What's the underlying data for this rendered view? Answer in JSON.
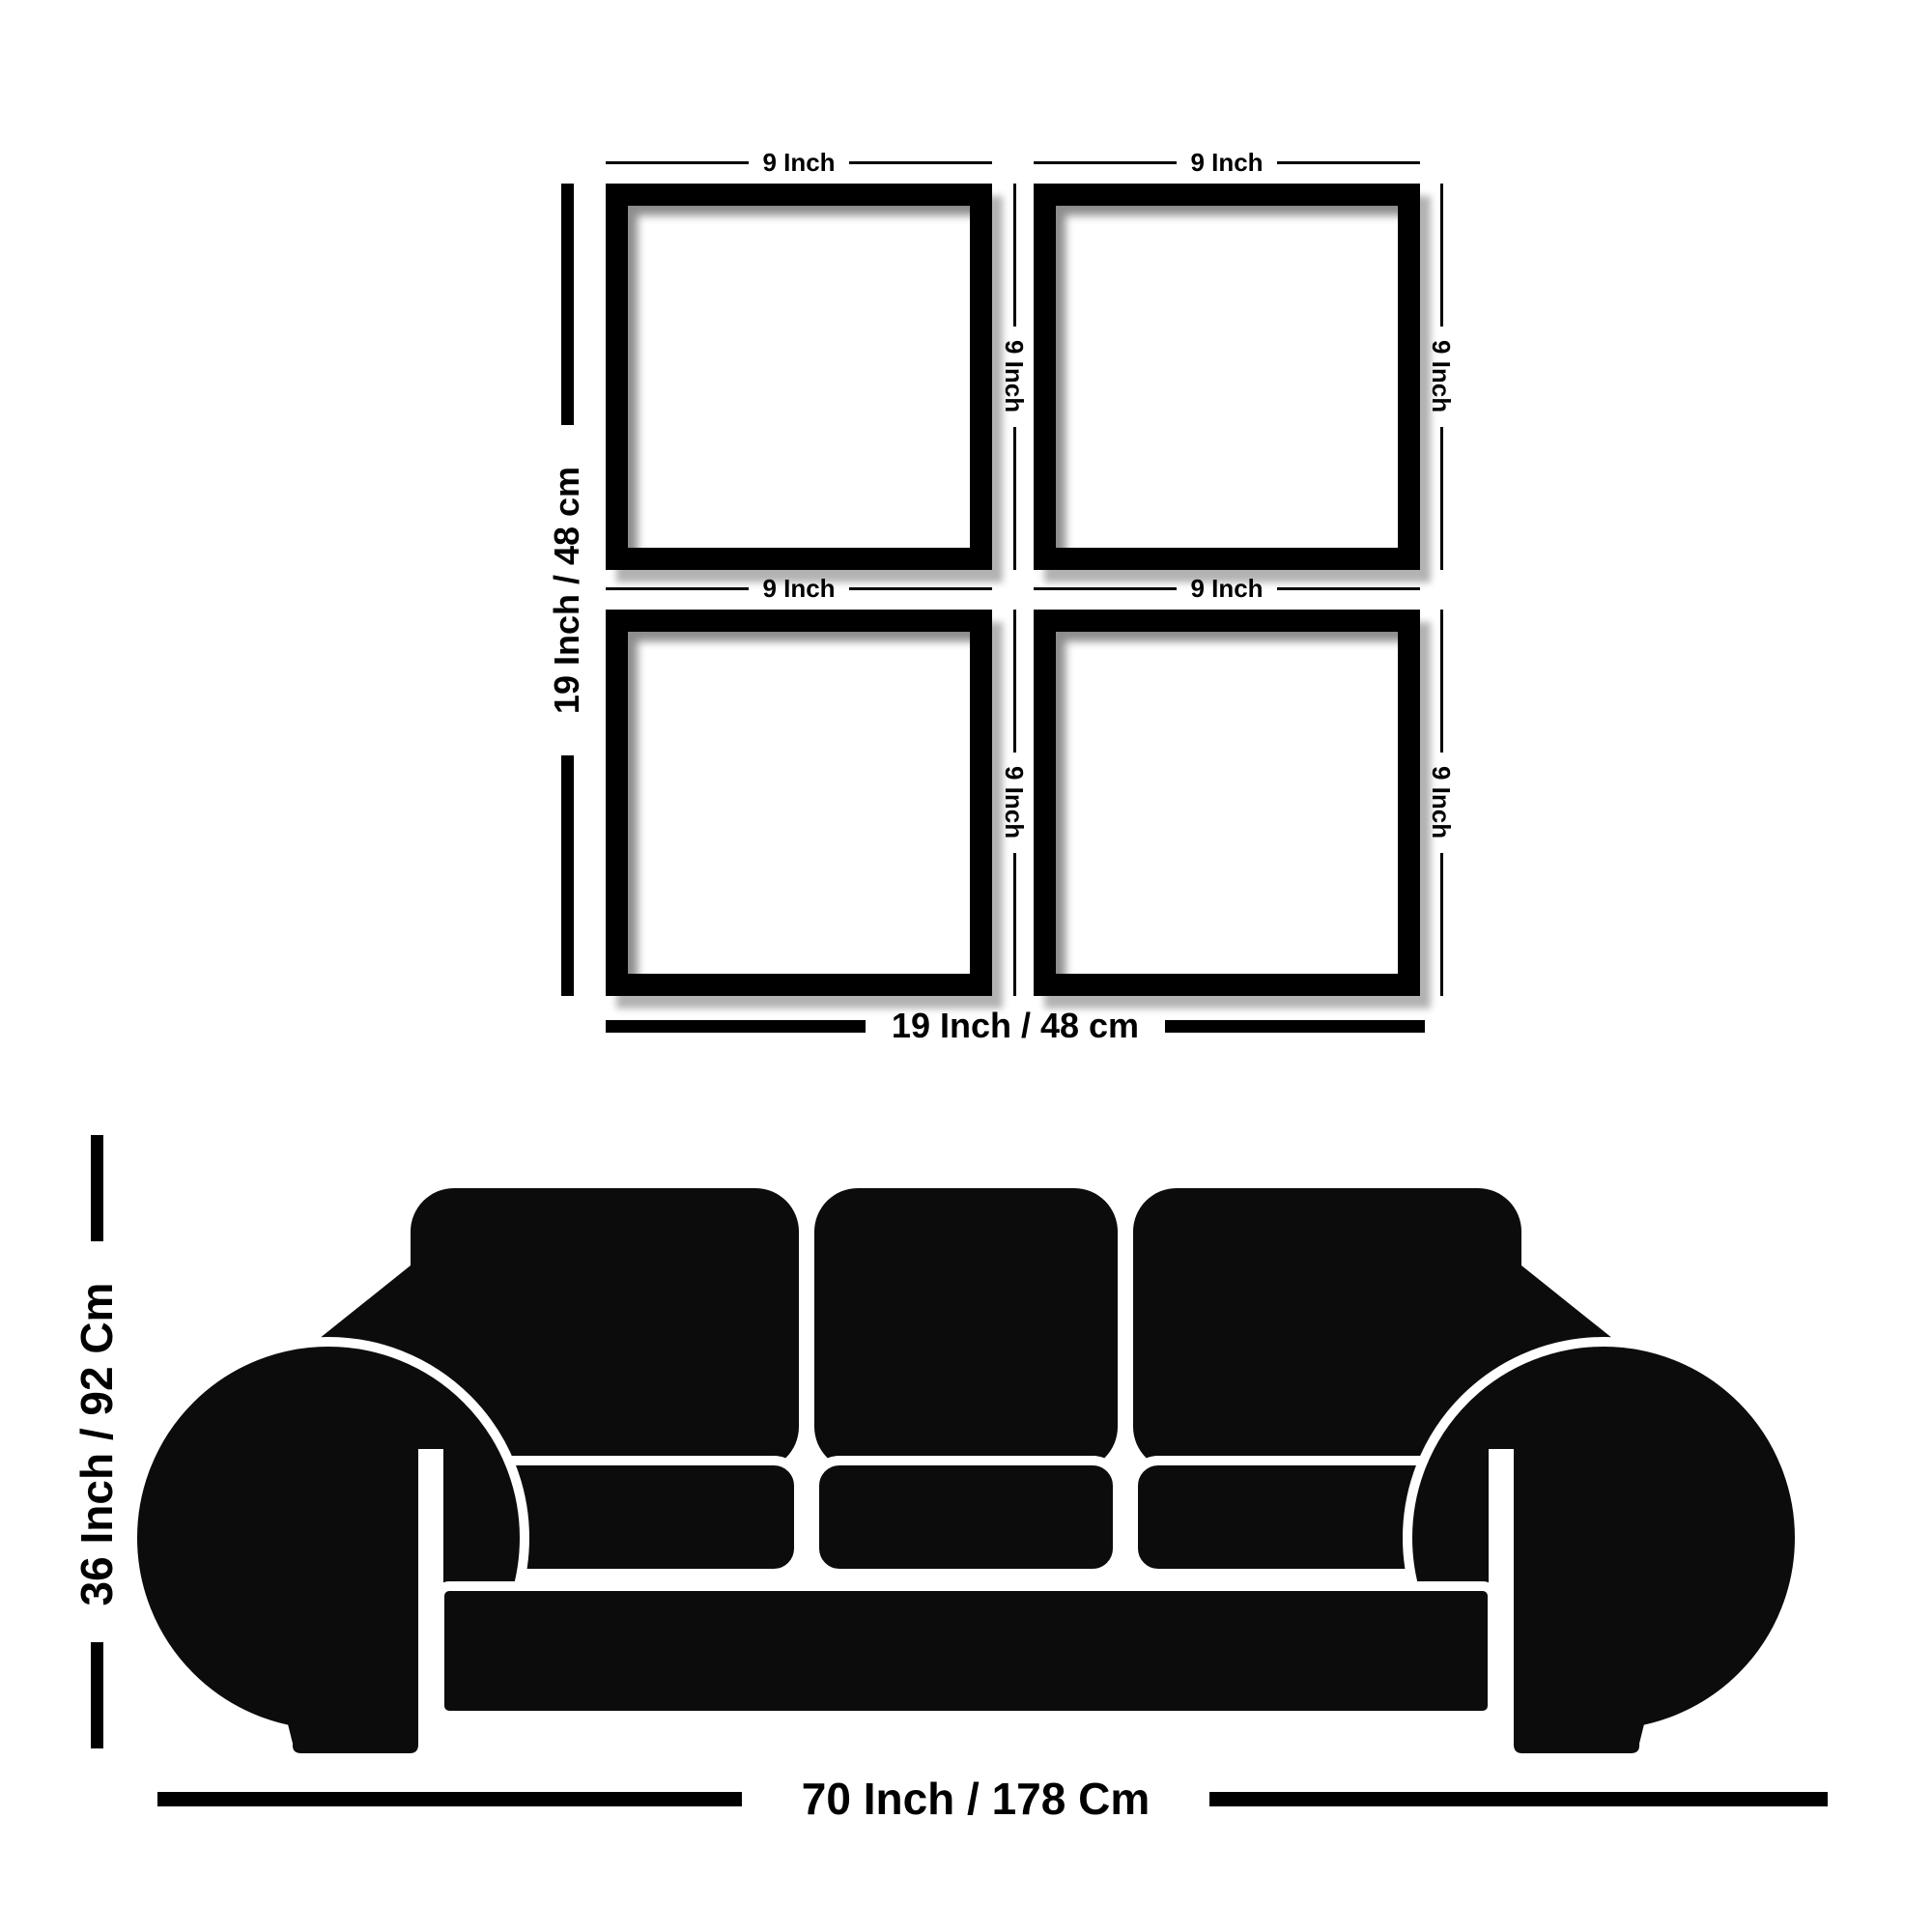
{
  "frames_diagram": {
    "frames": [
      {
        "position": "top-left",
        "top_label": "9 Inch",
        "side_label": "9 Inch"
      },
      {
        "position": "top-right",
        "top_label": "9 Inch",
        "side_label": "9 Inch"
      },
      {
        "position": "bottom-left",
        "top_label": "9 Inch",
        "side_label": "9 Inch"
      },
      {
        "position": "bottom-right",
        "top_label": "9 Inch",
        "side_label": "9 Inch"
      }
    ],
    "total_height_label": "19 Inch / 48 cm",
    "total_width_label": "19 Inch / 48 cm"
  },
  "sofa_diagram": {
    "height_label": "36 Inch / 92 Cm",
    "width_label": "70 Inch / 178 Cm"
  },
  "colors": {
    "ink": "#000000",
    "sofa": "#0c0c0c",
    "background": "#ffffff"
  }
}
